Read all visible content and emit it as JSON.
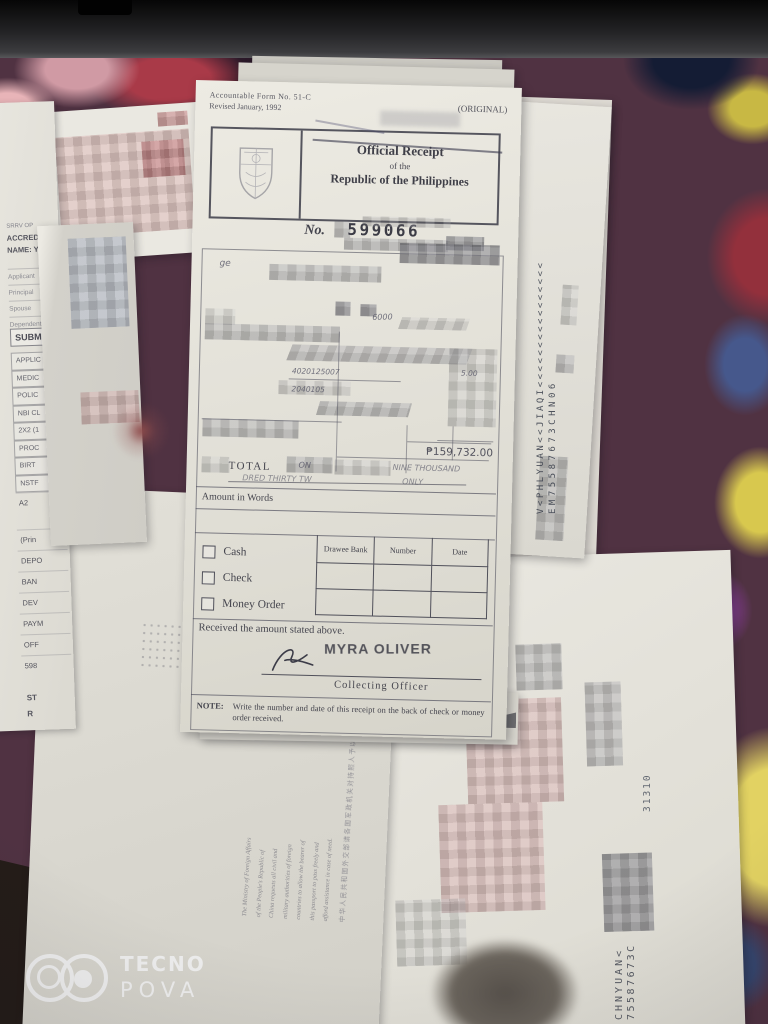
{
  "photo": {
    "watermark": {
      "brand": "TECNO",
      "model": "POVA"
    }
  },
  "receipt": {
    "form_line1": "Accountable Form No. 51-C",
    "form_line2": "Revised January, 1992",
    "original_label": "(ORIGINAL)",
    "title_line1": "Official Receipt",
    "title_line2": "of the",
    "title_line3": "Republic of the Philippines",
    "no_label": "No.",
    "receipt_number": "599066",
    "handwriting": {
      "ge": "ge",
      "h6000": "6000",
      "acct1": "4020125007",
      "fee1": "5.00",
      "acct2": "2040105"
    },
    "amount": "₱159,732.00",
    "total_label": "TOTAL",
    "amount_words_fragment1": "ON",
    "amount_words_fragment2": "NINE THOUSAND",
    "amount_words_fragment3": "DRED THIRTY TW",
    "amount_words_fragment4": "ONLY",
    "amount_in_words_label": "Amount in Words",
    "payment": {
      "options": [
        "Cash",
        "Check",
        "Money Order"
      ],
      "columns": [
        "Drawee Bank",
        "Number",
        "Date"
      ]
    },
    "received_text": "Received the amount stated above.",
    "officer_stamp": "MYRA OLIVER",
    "officer_label": "Collecting Officer",
    "note_label": "NOTE:",
    "note_text": "Write the number and date of this receipt on the back of check or money order received."
  },
  "left_form": {
    "header": [
      "SRRV OP",
      "ACCRED",
      "NAME: Y"
    ],
    "type_rows": [
      "Applicant",
      "Principal",
      "Spouse",
      "Dependent"
    ],
    "submitted_label": "SUBM",
    "checklist": [
      "APPLIC",
      "MEDIC",
      "POLIC",
      "NBI CL",
      "2X2 (1",
      "PROC",
      "BIRT",
      "NSTF"
    ],
    "lower": [
      "A2",
      "(Prin",
      "DEPO",
      "BAN",
      "DEV",
      "PAYM",
      "OFF",
      "598"
    ],
    "footer": [
      "ST",
      "R"
    ]
  },
  "passport_right": {
    "mrz_line1": "V<PHLYUAN<<JIAQI<<<<<<<<<<<<<<<<",
    "mrz_line2": "EM75587673CHN06"
  },
  "passport_bottom": {
    "mrz_line1": "CHNYUAN<",
    "mrz_line2": "75587673C",
    "serial": "31310"
  },
  "note_page": {
    "english_lines": [
      "The Ministry of Foreign Affairs",
      "of the People's Republic of",
      "China requests all civil and",
      "military authorities of foreign",
      "countries to allow the bearer of",
      "this passport to pass freely and",
      "afford assistance in case of need."
    ],
    "chinese": "中华人民共和国外交部请各国军政机关对持照人予以通行的便利和必要的协助。"
  }
}
